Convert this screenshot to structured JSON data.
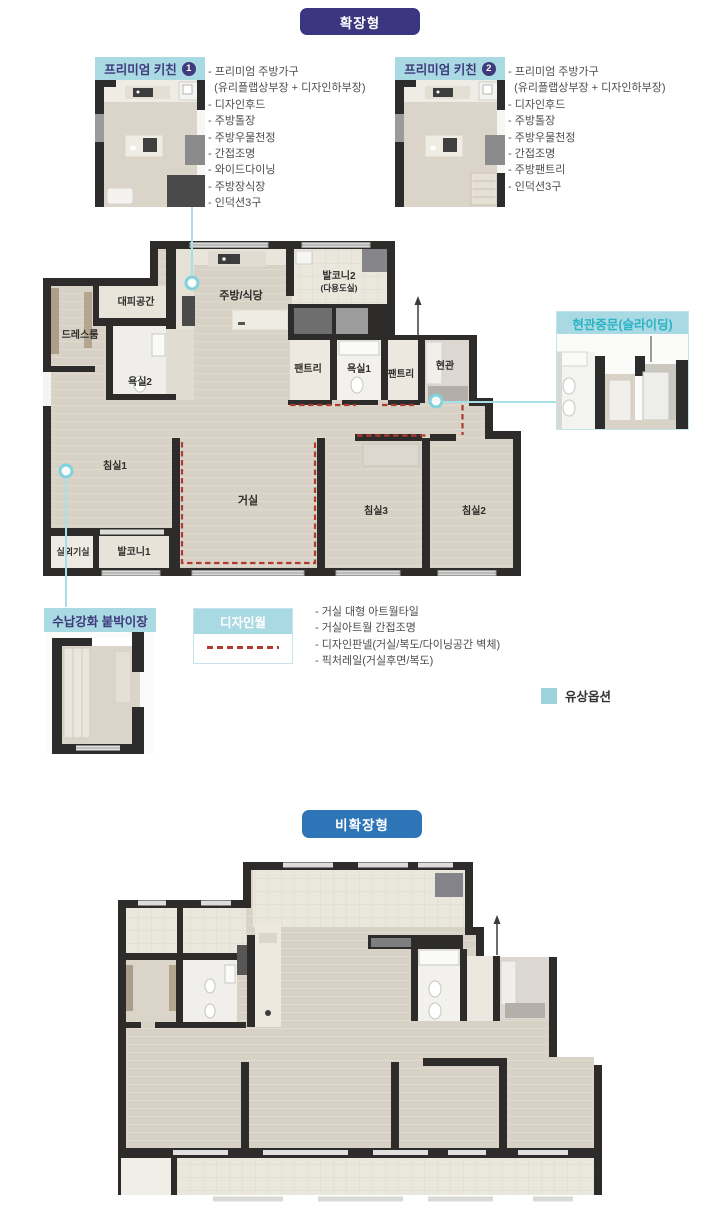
{
  "badges": {
    "extended": "확장형",
    "non_extended": "비확장형"
  },
  "callouts": {
    "premium_kitchen_1": {
      "title": "프리미엄 키친",
      "badge_number": "1",
      "lines": [
        "- 프리미엄 주방가구",
        "  (유리플랩상부장 + 디자인하부장)",
        "- 디자인후드",
        "- 주방톨장",
        "- 주방우물천정",
        "- 간접조명",
        "- 와이드다이닝",
        "- 주방장식장",
        "- 인덕션3구"
      ]
    },
    "premium_kitchen_2": {
      "title": "프리미엄 키친",
      "badge_number": "2",
      "lines": [
        "- 프리미엄 주방가구",
        "  (유리플랩상부장 + 디자인하부장)",
        "- 디자인후드",
        "- 주방톨장",
        "- 주방우물천정",
        "- 간접조명",
        "- 주방팬트리",
        "- 인덕션3구"
      ]
    },
    "entrance_door": {
      "title": "현관중문(슬라이딩)"
    },
    "storage_closet": {
      "title": "수납강화 붙박이장"
    },
    "design_wall": {
      "title": "디자인월",
      "lines": [
        "- 거실 대형 아트월타일",
        "- 거실아트월 간접조명",
        "- 디자인판넬(거실/복도/다이닝공간 벽체)",
        "- 픽처레일(거실후면/복도)"
      ]
    }
  },
  "legend": {
    "paid_option": "유상옵션"
  },
  "plan_extended": {
    "rooms": {
      "evacuation_space": "대피공간",
      "dress_room": "드레스룸",
      "bathroom2": "욕실2",
      "kitchen_dining": "주방/식당",
      "balcony2": "발코니2",
      "balcony2_note": "(다용도실)",
      "pantry_a": "팬트리",
      "bathroom1": "욕실1",
      "pantry_b": "팬트리",
      "entrance": "현관",
      "bedroom1": "침실1",
      "living_room": "거실",
      "bedroom3": "침실3",
      "bedroom2": "침실2",
      "outdoor_unit_room": "실외기실",
      "balcony1": "발코니1"
    }
  },
  "colors": {
    "extended_badge": "#3b3680",
    "non_extended_badge": "#2e75b8",
    "callout_header_bg": "#a9d9e2",
    "callout_header_text": "#3f3a7c",
    "entrance_title_text": "#2ab3c6",
    "design_wall_title_text": "#ffffff",
    "red_dash": "#b23b31",
    "connector": "#a6e0e8",
    "paid_swatch": "#9ed2dd",
    "wall": "#2e2c2a",
    "floor": "#d8d1c5"
  }
}
